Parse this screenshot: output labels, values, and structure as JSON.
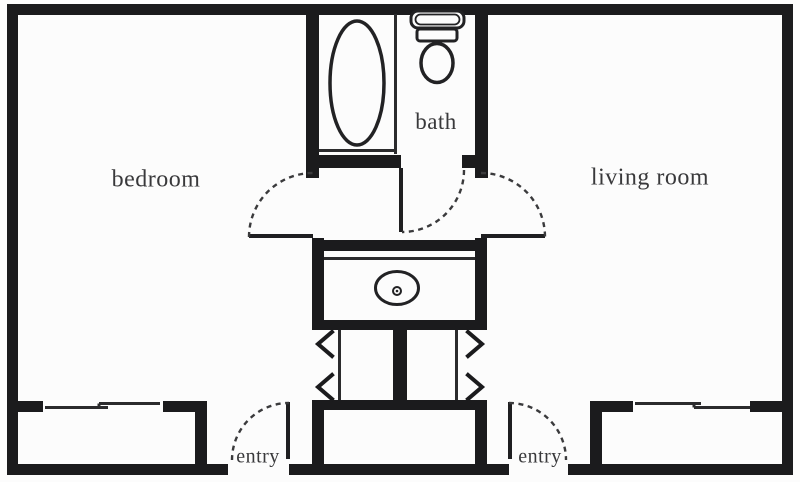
{
  "plan": {
    "title": "apartment floor plan",
    "labels": {
      "bedroom": "bedroom",
      "bath": "bath",
      "living_room": "living room",
      "entry_left": "entry",
      "entry_right": "entry"
    },
    "fixtures": [
      "bathtub",
      "toilet",
      "vanity-sink",
      "closet-bifold-doors",
      "swing-doors",
      "windows"
    ],
    "colors": {
      "wall": "#1b1b1d",
      "line": "#2b2b2d",
      "text": "#39393b",
      "background": "#fcfcfc"
    }
  }
}
